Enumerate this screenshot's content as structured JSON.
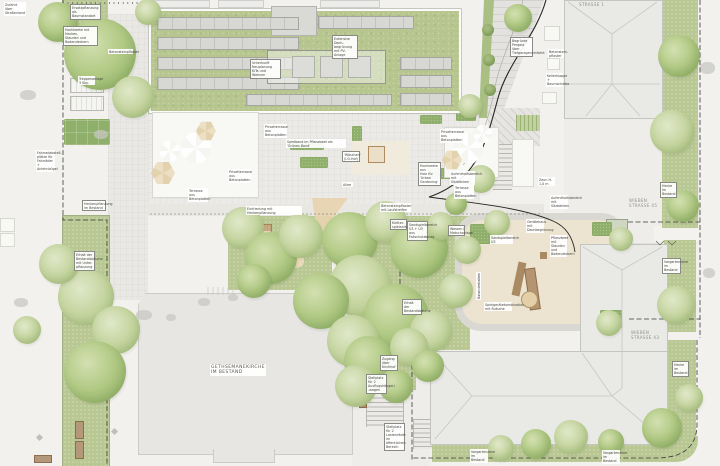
{
  "palette": {
    "paper": "#f2f1ed",
    "roof_green": "#b6c68e",
    "lawn_green": "#b9c893",
    "tree_green": "#a9c37d",
    "sand": "#ead9b9",
    "building_grey": "#e9e9e6",
    "paving": "#ebeae6",
    "boundary_line": "#3a3a38",
    "bench_brown": "#b5977a"
  },
  "buildings": {
    "church": "GETHSEMANEKIRCHE\nIM BESTAND",
    "strasse1": "STRASSE 1",
    "wieben45": "WIEBEN\nSTRASSE 45",
    "wieben43": "WIEBEN\nSTRASSE 43"
  },
  "annotations": {
    "zufahrt": "Zufahrt über\nStraßenland",
    "ersatzpflanzung": "Ersatzpflanzung als\nBaumstandort",
    "hochbeete": "Hochbeete mit Hecken,\nStauden und Bodendeckern",
    "betonstein_west": "Betonsteinpflaster",
    "treppe": "Treppenanlage\n3 Stg.",
    "fahrrad_west": "Fahrradabstell-\nplätze für\nFahrräder +\nAnlehnbügel",
    "hecke_west": "Heckenpflanzung\nim Bestand",
    "erhalt_west": "Erhalt der\nBestandsbäume\nmit Unter-\npflanzung",
    "dach_neu": "Unterkunft Neuplanung\nKiTa und Wohnen",
    "dach_pv": "Extensive Dach-\nbegrünung mit PV-\nAnlage",
    "privatterrasse": "Privatterrasse\naus Betonplatten",
    "terrasse": "Terrasse aus\nBetonplatten",
    "gruenes_band": "Spielband im Pflanzbeet als 'Grünes Band'",
    "waeschen": "'Wäschen'\n(U3-Hof)",
    "urban_gardening": "Hochbeete aus\nHolz für 'Urban\nGardening'",
    "aufenthalt": "Aufenthaltsbereich\nmit Sitzbänken",
    "zaun": "Zaun H. 1,0 m",
    "einfriedung": "Einfriedung mit Heckenpflanzung",
    "allee": "Allee",
    "laufstreifen": "Betonsteinpflaster mit Laufstreifen",
    "kletteranlage": "Kletter-\nspielanlage",
    "sand_u3u6": "Sandspielbereich\nU3 + Ü3 aus\nFallschutzbelag",
    "wasser": "Wasser-/\nMatschanlage",
    "sandspiel_u3": "Sandspielbereich U3",
    "geraetehaus": "Gerätehaus mit\nDachbegrünung",
    "pflanzbeet": "Pflanzbeet mit\nStauden und\nBodendeckern",
    "balancier": "Balancierbalken",
    "spielkombi": "Spielgerätekombination\nmit Rutsche",
    "erhalt_mitte": "Erhalt der\nBestandsbäume",
    "pergola": "Begrünte\nPergola über\nTiefgarageneinfahrt",
    "betonstein_ost": "Betonstein-\npflaster",
    "kellerklappe": "Kellerklappe +\nBaumscheibe",
    "hecke_bestand": "Hecke im\nBestand",
    "vorgarten_bestand": "Vorgartenzone\nim Bestand",
    "zugang_kirchhof": "Zugang über\nKirchhof",
    "stellplatz_wagen": "Stellplatz für 2\nAusflugshänger/\n-wagen",
    "stellplatz_lasten": "Stellplatz für 2\nLastenräder im\nöffentlichen Bereich"
  }
}
